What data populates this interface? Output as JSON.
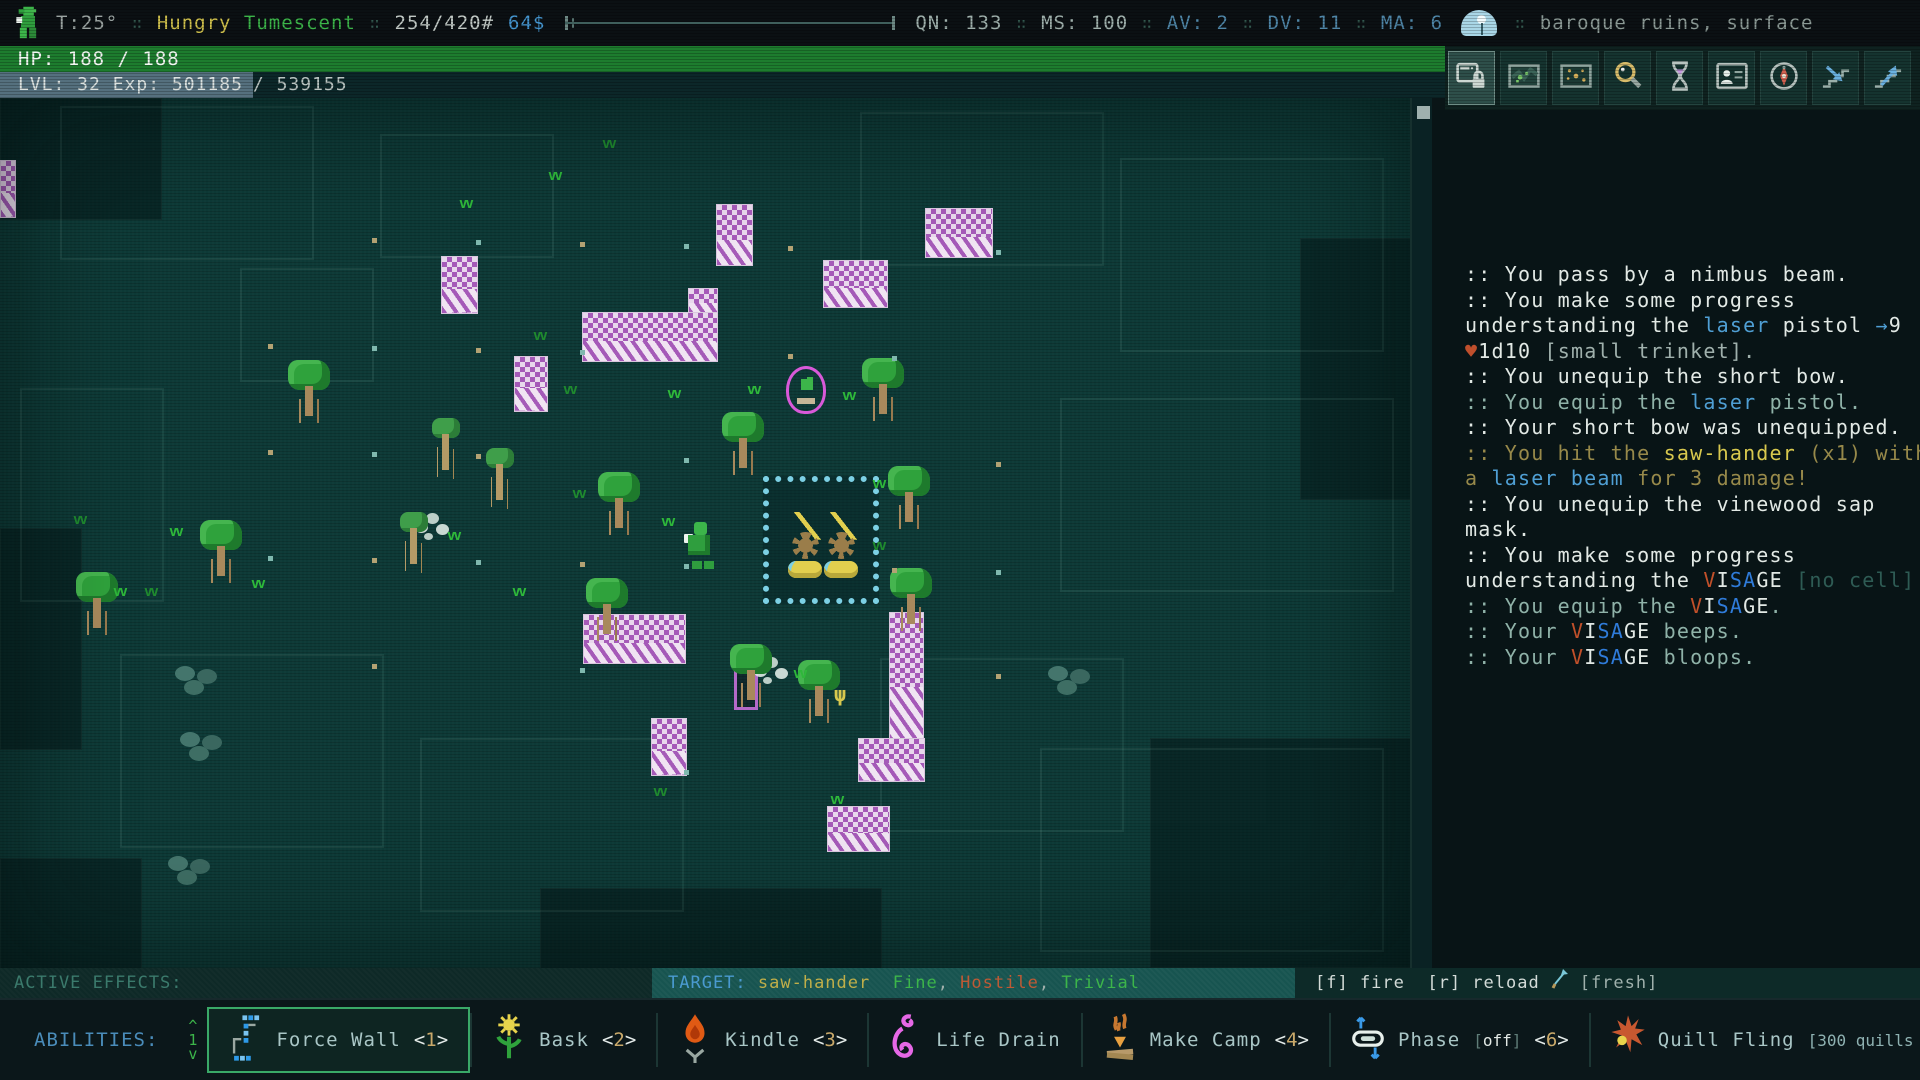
{
  "palette": {
    "w": "#e2e9e5",
    "d": "#8fb2a8",
    "b": "#4f9fd4",
    "B": "#2f7bd9",
    "y": "#d8c84e",
    "o": "#97894a",
    "r": "#bf4f2c",
    "t": "#2e5b54",
    "g": "#9fb0ac",
    "V": "#c1502a",
    "tb": "#4a9ad0",
    "y2": "#bfae49",
    "gr": "#3cb54a",
    "rd": "#bf5a35",
    "dm": "#5f7d78",
    "lb": "#8fb2b2",
    "gray": "#9fb0ac",
    "blue": "#4f86a8"
  },
  "top_bar": {
    "separator": "∷",
    "temperature": "T:25°",
    "status_effects": [
      {
        "label": "Hungry",
        "color": "#cfc04c"
      },
      {
        "label": "Tumescent",
        "color": "#3cb54a"
      }
    ],
    "weight": "254/420#",
    "money": "64$",
    "stats": [
      {
        "text": "QN: 133",
        "c": "gray"
      },
      {
        "text": "MS: 100",
        "c": "gray"
      },
      {
        "text": "AV: 2",
        "c": "blue"
      },
      {
        "text": "DV: 11",
        "c": "blue"
      },
      {
        "text": "MA: 6",
        "c": "blue"
      }
    ],
    "location": "baroque ruins, surface"
  },
  "hp_bar": {
    "text": "HP: 188 / 188"
  },
  "exp_bar": {
    "filled": "LVL: 32 Exp: 501185",
    "rest": " / 539155"
  },
  "toolbar": {
    "icons": [
      {
        "name": "ui-lock",
        "active": true
      },
      {
        "name": "world-map",
        "active": false
      },
      {
        "name": "mini-map",
        "active": false
      },
      {
        "name": "inspect",
        "active": false
      },
      {
        "name": "wait",
        "active": false
      },
      {
        "name": "character",
        "active": false
      },
      {
        "name": "compass",
        "active": false
      },
      {
        "name": "stairs-down",
        "active": false
      },
      {
        "name": "stairs-up",
        "active": false
      }
    ]
  },
  "message_log": {
    "lines": [
      [
        {
          "c": "w",
          "t": ":: You pass by a nimbus beam."
        }
      ],
      [
        {
          "c": "w",
          "t": ":: You make some progress"
        }
      ],
      [
        {
          "c": "w",
          "t": "understanding the "
        },
        {
          "c": "b",
          "t": "laser"
        },
        {
          "c": "w",
          "t": " pistol "
        },
        {
          "c": "b",
          "t": "→"
        },
        {
          "c": "w",
          "t": "9"
        }
      ],
      [
        {
          "c": "r",
          "t": "♥"
        },
        {
          "c": "w",
          "t": "1d10 "
        },
        {
          "c": "g",
          "t": "[small trinket]."
        }
      ],
      [
        {
          "c": "w",
          "t": ":: You unequip the short bow."
        }
      ],
      [
        {
          "c": "d",
          "t": ":: You equip the "
        },
        {
          "c": "b",
          "t": "laser"
        },
        {
          "c": "d",
          "t": " pistol."
        }
      ],
      [
        {
          "c": "w",
          "t": ":: Your short bow was unequipped."
        }
      ],
      [
        {
          "c": "o",
          "t": ":: You hit the "
        },
        {
          "c": "y",
          "t": "saw-hander"
        },
        {
          "c": "o",
          "t": " (x1) with"
        }
      ],
      [
        {
          "c": "o",
          "t": "a "
        },
        {
          "c": "b",
          "t": "laser beam"
        },
        {
          "c": "o",
          "t": " for 3 damage!"
        }
      ],
      [
        {
          "c": "w",
          "t": ":: You unequip the vinewood sap"
        }
      ],
      [
        {
          "c": "w",
          "t": "mask."
        }
      ],
      [
        {
          "c": "w",
          "t": ":: You make some progress"
        }
      ],
      [
        {
          "c": "w",
          "t": "understanding the "
        },
        {
          "c": "V",
          "t": "V"
        },
        {
          "c": "w",
          "t": "I"
        },
        {
          "c": "B",
          "t": "S"
        },
        {
          "c": "B",
          "t": "A"
        },
        {
          "c": "w",
          "t": "GE "
        },
        {
          "c": "t",
          "t": "[no cell]"
        },
        {
          "c": "w",
          "t": "."
        }
      ],
      [
        {
          "c": "d",
          "t": ":: You equip the "
        },
        {
          "c": "V",
          "t": "V"
        },
        {
          "c": "w",
          "t": "I"
        },
        {
          "c": "B",
          "t": "S"
        },
        {
          "c": "B",
          "t": "A"
        },
        {
          "c": "w",
          "t": "GE"
        },
        {
          "c": "d",
          "t": "."
        }
      ],
      [
        {
          "c": "d",
          "t": ":: Your "
        },
        {
          "c": "V",
          "t": "V"
        },
        {
          "c": "w",
          "t": "I"
        },
        {
          "c": "B",
          "t": "S"
        },
        {
          "c": "B",
          "t": "A"
        },
        {
          "c": "w",
          "t": "GE"
        },
        {
          "c": "d",
          "t": " beeps."
        }
      ],
      [
        {
          "c": "d",
          "t": ":: Your "
        },
        {
          "c": "V",
          "t": "V"
        },
        {
          "c": "w",
          "t": "I"
        },
        {
          "c": "B",
          "t": "S"
        },
        {
          "c": "B",
          "t": "A"
        },
        {
          "c": "w",
          "t": "GE"
        },
        {
          "c": "d",
          "t": " bloops."
        }
      ]
    ]
  },
  "status_row": {
    "active_effects_label": "ACTIVE EFFECTS:",
    "target_segments": [
      {
        "c": "tb",
        "t": "TARGET: "
      },
      {
        "c": "y2",
        "t": "saw-hander"
      },
      {
        "c": "g",
        "t": "  "
      },
      {
        "c": "gr",
        "t": "Fine"
      },
      {
        "c": "g",
        "t": ", "
      },
      {
        "c": "rd",
        "t": "Hostile"
      },
      {
        "c": "g",
        "t": ", "
      },
      {
        "c": "gr",
        "t": "Trivial"
      }
    ],
    "fire_text": "[f] fire  [r] reload",
    "fresh_label": "[fresh]"
  },
  "abilities": {
    "label": "ABILITIES:",
    "page": "1",
    "pager_up": "^",
    "pager_down": "v",
    "items": [
      {
        "icon": "force-wall",
        "name": "Force Wall",
        "hotkey": "1",
        "selected": true
      },
      {
        "icon": "bask",
        "name": "Bask",
        "hotkey": "2",
        "selected": false
      },
      {
        "icon": "kindle",
        "name": "Kindle",
        "hotkey": "3",
        "selected": false
      },
      {
        "icon": "life-drain",
        "name": "Life Drain",
        "selected": false
      },
      {
        "icon": "make-camp",
        "name": "Make Camp",
        "hotkey": "4",
        "selected": false
      },
      {
        "icon": "phase",
        "name": "Phase",
        "suffix": [
          {
            "c": "dm",
            "t": "["
          },
          {
            "c": "w",
            "t": "off"
          },
          {
            "c": "dm",
            "t": "]"
          }
        ],
        "hotkey": "6",
        "selected": false
      },
      {
        "icon": "quill-fling",
        "name": "Quill Fling",
        "suffix": [
          {
            "c": "lb",
            "t": "[300 quills left]"
          }
        ],
        "hotkey": "7",
        "selected": false
      }
    ]
  },
  "map": {
    "entities": [
      {
        "t": "block",
        "x": 0,
        "y": 0,
        "w": 160,
        "h": 120
      },
      {
        "t": "block",
        "x": 0,
        "y": 430,
        "w": 80,
        "h": 220
      },
      {
        "t": "block",
        "x": 1300,
        "y": 140,
        "w": 110,
        "h": 260
      },
      {
        "t": "block",
        "x": 1150,
        "y": 640,
        "w": 260,
        "h": 228
      },
      {
        "t": "block",
        "x": 540,
        "y": 790,
        "w": 340,
        "h": 80
      },
      {
        "t": "block",
        "x": 0,
        "y": 760,
        "w": 140,
        "h": 110
      },
      {
        "t": "room",
        "x": 60,
        "y": 8,
        "w": 250,
        "h": 150
      },
      {
        "t": "room",
        "x": 380,
        "y": 36,
        "w": 170,
        "h": 120
      },
      {
        "t": "room",
        "x": 860,
        "y": 14,
        "w": 240,
        "h": 150
      },
      {
        "t": "room",
        "x": 1120,
        "y": 60,
        "w": 260,
        "h": 190
      },
      {
        "t": "room",
        "x": 20,
        "y": 290,
        "w": 140,
        "h": 210
      },
      {
        "t": "room",
        "x": 1060,
        "y": 300,
        "w": 330,
        "h": 190
      },
      {
        "t": "room",
        "x": 120,
        "y": 556,
        "w": 260,
        "h": 190
      },
      {
        "t": "room",
        "x": 880,
        "y": 560,
        "w": 240,
        "h": 170
      },
      {
        "t": "room",
        "x": 420,
        "y": 640,
        "w": 260,
        "h": 170
      },
      {
        "t": "room",
        "x": 1040,
        "y": 650,
        "w": 340,
        "h": 200
      },
      {
        "t": "room",
        "x": 240,
        "y": 170,
        "w": 130,
        "h": 110
      },
      {
        "t": "wall",
        "x": 0,
        "y": 62,
        "w": 16,
        "h": 58
      },
      {
        "t": "wall",
        "x": 441,
        "y": 158,
        "w": 37,
        "h": 58
      },
      {
        "t": "wall",
        "x": 716,
        "y": 106,
        "w": 37,
        "h": 62
      },
      {
        "t": "wall",
        "x": 925,
        "y": 110,
        "w": 68,
        "h": 50
      },
      {
        "t": "wall",
        "x": 823,
        "y": 162,
        "w": 65,
        "h": 48
      },
      {
        "t": "wall",
        "x": 688,
        "y": 190,
        "w": 30,
        "h": 26
      },
      {
        "t": "wall",
        "x": 582,
        "y": 214,
        "w": 136,
        "h": 50
      },
      {
        "t": "wall",
        "x": 514,
        "y": 258,
        "w": 34,
        "h": 56
      },
      {
        "t": "wall",
        "x": 583,
        "y": 516,
        "w": 103,
        "h": 50
      },
      {
        "t": "wall",
        "x": 889,
        "y": 514,
        "w": 35,
        "h": 130
      },
      {
        "t": "wall",
        "x": 858,
        "y": 640,
        "w": 67,
        "h": 44
      },
      {
        "t": "wall",
        "x": 651,
        "y": 620,
        "w": 36,
        "h": 58
      },
      {
        "t": "wall",
        "x": 827,
        "y": 708,
        "w": 63,
        "h": 46
      },
      {
        "t": "door",
        "x": 734,
        "y": 566,
        "w": 24,
        "h": 46
      },
      {
        "t": "fence",
        "x": 763,
        "y": 378,
        "w": 116,
        "h": 128
      },
      {
        "t": "saw",
        "x": 788,
        "y": 414
      },
      {
        "t": "saw",
        "x": 824,
        "y": 414
      },
      {
        "t": "bub",
        "x": 786,
        "y": 268
      },
      {
        "t": "player",
        "x": 684,
        "y": 424
      },
      {
        "t": "mist",
        "x": 415,
        "y": 424
      },
      {
        "t": "mist",
        "x": 754,
        "y": 568
      },
      {
        "t": "plant",
        "x": 834,
        "y": 584
      },
      {
        "t": "tree",
        "x": 720,
        "y": 314
      },
      {
        "t": "tree",
        "x": 860,
        "y": 260
      },
      {
        "t": "tree",
        "x": 886,
        "y": 368
      },
      {
        "t": "tree",
        "x": 888,
        "y": 470
      },
      {
        "t": "tree",
        "x": 286,
        "y": 262
      },
      {
        "t": "tree",
        "x": 198,
        "y": 422
      },
      {
        "t": "tree",
        "x": 596,
        "y": 374
      },
      {
        "t": "tree",
        "x": 584,
        "y": 480
      },
      {
        "t": "tree",
        "x": 728,
        "y": 546
      },
      {
        "t": "tree",
        "x": 796,
        "y": 562
      },
      {
        "t": "tree",
        "x": 74,
        "y": 474
      },
      {
        "t": "ttree",
        "x": 426,
        "y": 320
      },
      {
        "t": "ttree",
        "x": 394,
        "y": 414
      },
      {
        "t": "ttree",
        "x": 480,
        "y": 350
      },
      {
        "t": "grass",
        "x": 459,
        "y": 98
      },
      {
        "t": "grass2",
        "x": 533,
        "y": 230
      },
      {
        "t": "grass",
        "x": 667,
        "y": 288
      },
      {
        "t": "grass",
        "x": 747,
        "y": 284
      },
      {
        "t": "grass2",
        "x": 572,
        "y": 388
      },
      {
        "t": "grass",
        "x": 661,
        "y": 416
      },
      {
        "t": "grass",
        "x": 512,
        "y": 486
      },
      {
        "t": "grass2",
        "x": 144,
        "y": 486
      },
      {
        "t": "grass",
        "x": 113,
        "y": 486
      },
      {
        "t": "grass",
        "x": 447,
        "y": 430
      },
      {
        "t": "grass2",
        "x": 563,
        "y": 284
      },
      {
        "t": "grass",
        "x": 872,
        "y": 378
      },
      {
        "t": "grass",
        "x": 793,
        "y": 568
      },
      {
        "t": "grass2",
        "x": 653,
        "y": 686
      },
      {
        "t": "grass",
        "x": 830,
        "y": 694
      },
      {
        "t": "grass2",
        "x": 73,
        "y": 414
      },
      {
        "t": "grass",
        "x": 169,
        "y": 426
      },
      {
        "t": "grass",
        "x": 842,
        "y": 290
      },
      {
        "t": "grass2",
        "x": 872,
        "y": 440
      },
      {
        "t": "grass",
        "x": 251,
        "y": 478
      },
      {
        "t": "grass",
        "x": 548,
        "y": 70
      },
      {
        "t": "grass2",
        "x": 602,
        "y": 38
      },
      {
        "t": "dot",
        "x": 372,
        "y": 140
      },
      {
        "t": "dot2",
        "x": 476,
        "y": 142
      },
      {
        "t": "dot",
        "x": 580,
        "y": 144
      },
      {
        "t": "dot2",
        "x": 684,
        "y": 146
      },
      {
        "t": "dot",
        "x": 788,
        "y": 148
      },
      {
        "t": "dot2",
        "x": 996,
        "y": 152
      },
      {
        "t": "dot",
        "x": 268,
        "y": 246
      },
      {
        "t": "dot2",
        "x": 372,
        "y": 248
      },
      {
        "t": "dot",
        "x": 476,
        "y": 250
      },
      {
        "t": "dot2",
        "x": 580,
        "y": 252
      },
      {
        "t": "dot",
        "x": 788,
        "y": 256
      },
      {
        "t": "dot2",
        "x": 892,
        "y": 258
      },
      {
        "t": "dot",
        "x": 268,
        "y": 352
      },
      {
        "t": "dot2",
        "x": 372,
        "y": 354
      },
      {
        "t": "dot",
        "x": 476,
        "y": 356
      },
      {
        "t": "dot2",
        "x": 684,
        "y": 360
      },
      {
        "t": "dot",
        "x": 996,
        "y": 364
      },
      {
        "t": "dot2",
        "x": 268,
        "y": 458
      },
      {
        "t": "dot",
        "x": 372,
        "y": 460
      },
      {
        "t": "dot2",
        "x": 476,
        "y": 462
      },
      {
        "t": "dot",
        "x": 580,
        "y": 464
      },
      {
        "t": "dot2",
        "x": 684,
        "y": 466
      },
      {
        "t": "dot",
        "x": 892,
        "y": 470
      },
      {
        "t": "dot2",
        "x": 996,
        "y": 472
      },
      {
        "t": "dot",
        "x": 372,
        "y": 566
      },
      {
        "t": "dot2",
        "x": 580,
        "y": 570
      },
      {
        "t": "dot",
        "x": 996,
        "y": 576
      },
      {
        "t": "dot2",
        "x": 684,
        "y": 672
      },
      {
        "t": "rub",
        "x": 175,
        "y": 568
      },
      {
        "t": "rub",
        "x": 180,
        "y": 634
      },
      {
        "t": "rub",
        "x": 1048,
        "y": 568
      },
      {
        "t": "rub",
        "x": 168,
        "y": 758
      }
    ]
  }
}
